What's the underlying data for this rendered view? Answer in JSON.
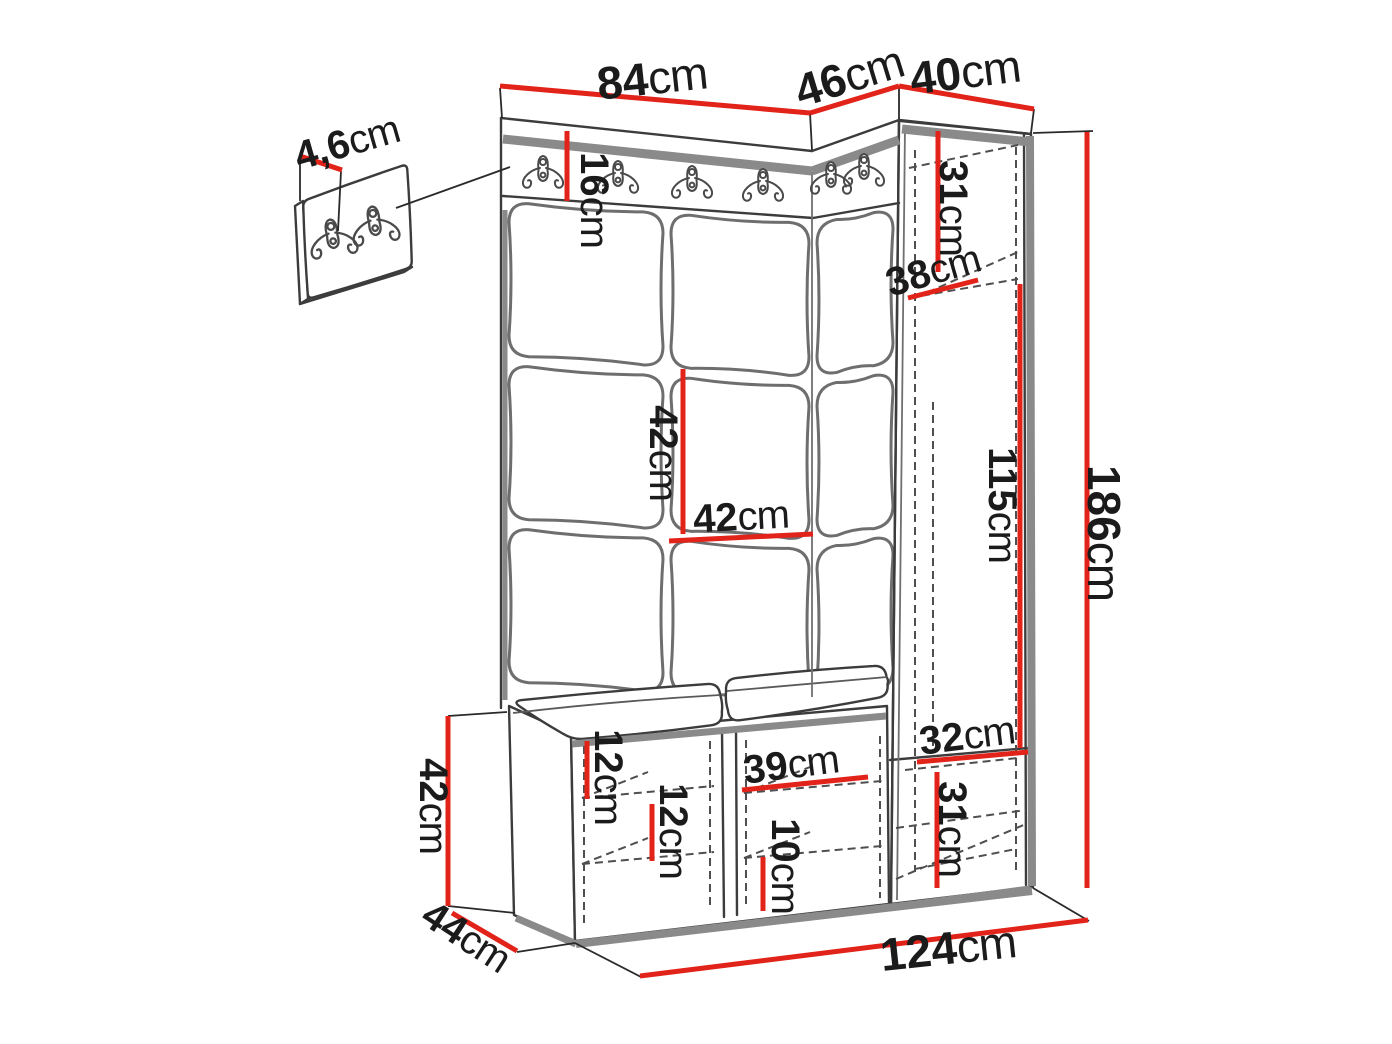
{
  "detail_inset": {
    "dimension": {
      "value": "4,6",
      "unit": "cm"
    },
    "hook_count": 2
  },
  "icons": {
    "coat_hook": "double-coat-hook-icon",
    "main_rail_hook_count": 6
  },
  "dimensions": {
    "top_front_width": {
      "value": "84",
      "unit": "cm"
    },
    "top_corner_width": {
      "value": "46",
      "unit": "cm"
    },
    "cabinet_width": {
      "value": "40",
      "unit": "cm"
    },
    "hook_rail_height": {
      "value": "16",
      "unit": "cm"
    },
    "cabinet_top_compartment_height": {
      "value": "31",
      "unit": "cm"
    },
    "cabinet_shelf_depth": {
      "value": "38",
      "unit": "cm"
    },
    "panel_tile_height": {
      "value": "42",
      "unit": "cm"
    },
    "panel_tile_width": {
      "value": "42",
      "unit": "cm"
    },
    "cabinet_inner_height": {
      "value": "115",
      "unit": "cm"
    },
    "total_height": {
      "value": "186",
      "unit": "cm"
    },
    "cabinet_bottom_shelf_width": {
      "value": "32",
      "unit": "cm"
    },
    "bench_height": {
      "value": "42",
      "unit": "cm"
    },
    "bench_depth": {
      "value": "44",
      "unit": "cm"
    },
    "bench_left_shelf_height": {
      "value": "12",
      "unit": "cm"
    },
    "bench_left_lower_shelf_height": {
      "value": "12",
      "unit": "cm"
    },
    "bench_middle_shelf_width": {
      "value": "39",
      "unit": "cm"
    },
    "bench_middle_shelf_height": {
      "value": "10",
      "unit": "cm"
    },
    "cabinet_bottom_compartment_height": {
      "value": "31",
      "unit": "cm"
    },
    "total_width": {
      "value": "124",
      "unit": "cm"
    }
  },
  "colors": {
    "dimension_red": "#e2231a",
    "outline_dark": "#3c3c3c",
    "shadow_gray": "#8a8a8a",
    "text": "#1b1b1b",
    "background": "#ffffff"
  }
}
